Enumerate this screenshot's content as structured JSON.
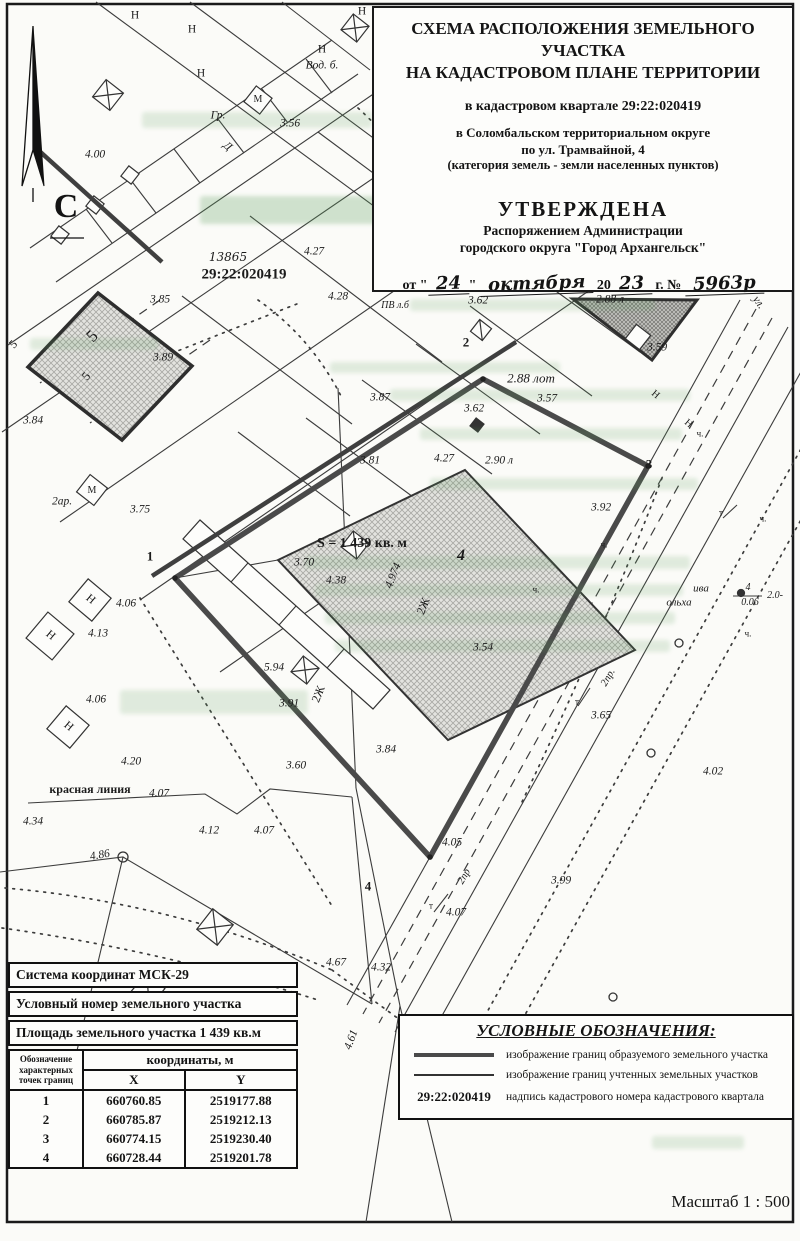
{
  "header": {
    "title_line1": "СХЕМА РАСПОЛОЖЕНИЯ ЗЕМЕЛЬНОГО УЧАСТКА",
    "title_line2": "НА КАДАСТРОВОМ ПЛАНЕ ТЕРРИТОРИИ",
    "subtitle_lines": [
      "в кадастровом квартале 29:22:020419",
      "в Соломбальском территориальном округе",
      "по ул. Трамвайной, 4",
      "(категория земель - земли населенных пунктов)"
    ],
    "approval": {
      "heading": "УТВЕРЖДЕНА",
      "org_line1": "Распоряжением Администрации",
      "org_line2": "городского округа \"Город Архангельск\"",
      "date_prefix": "от \"",
      "day": "24",
      "date_close": "\"",
      "month": "октября",
      "year_prefix": "20",
      "year": "23",
      "num_prefix": "г. №",
      "number": "5963р"
    },
    "scale_label": "Масштаб  1 : 500"
  },
  "compass": {
    "label": "С"
  },
  "map": {
    "area_label": "S = 1 439 кв. м",
    "quarter_number": "29:22:020419",
    "labels": [
      {
        "t": "4.00",
        "x": 95,
        "y": 155,
        "i": 1
      },
      {
        "t": "Н",
        "x": 135,
        "y": 16
      },
      {
        "t": "Н",
        "x": 192,
        "y": 30
      },
      {
        "t": "Н",
        "x": 201,
        "y": 74
      },
      {
        "t": "Н",
        "x": 322,
        "y": 50
      },
      {
        "t": "Н",
        "x": 362,
        "y": 12
      },
      {
        "t": "Вод. б.",
        "x": 322,
        "y": 66,
        "i": 1
      },
      {
        "t": "Гр.",
        "x": 218,
        "y": 116,
        "i": 1
      },
      {
        "t": "3.56",
        "x": 290,
        "y": 124,
        "i": 1
      },
      {
        "t": "Д",
        "x": 227,
        "y": 147,
        "r": 40,
        "i": 1
      },
      {
        "t": "М",
        "x": 258,
        "y": 100,
        "s": 10
      },
      {
        "t": "13865",
        "x": 228,
        "y": 257,
        "i": 1,
        "h": 1,
        "s": 12
      },
      {
        "t": "29:22:020419",
        "x": 244,
        "y": 275,
        "b": 1,
        "s": 15
      },
      {
        "t": "4.27",
        "x": 314,
        "y": 252,
        "i": 1
      },
      {
        "t": "4.28",
        "x": 338,
        "y": 297,
        "i": 1
      },
      {
        "t": "ПВ л.б",
        "x": 395,
        "y": 306,
        "s": 10,
        "i": 1
      },
      {
        "t": "3.62",
        "x": 478,
        "y": 301,
        "i": 1
      },
      {
        "t": "2.88 л",
        "x": 610,
        "y": 300,
        "i": 1
      },
      {
        "t": "ул.",
        "x": 758,
        "y": 303,
        "r": 55,
        "i": 1
      },
      {
        "t": "2",
        "x": 466,
        "y": 342,
        "b": 1,
        "s": 13
      },
      {
        "t": "3.59",
        "x": 657,
        "y": 348,
        "i": 1
      },
      {
        "t": "3.85",
        "x": 160,
        "y": 300,
        "i": 1
      },
      {
        "t": "3.89",
        "x": 163,
        "y": 358,
        "i": 1
      },
      {
        "t": "3.84",
        "x": 33,
        "y": 421,
        "i": 1
      },
      {
        "t": "5",
        "x": 92,
        "y": 336,
        "r": -45,
        "s": 17
      },
      {
        "t": "5",
        "x": 13,
        "y": 344,
        "r": -45,
        "s": 12
      },
      {
        "t": "5",
        "x": 86,
        "y": 376,
        "r": -50,
        "s": 12
      },
      {
        "t": "2ар.",
        "x": 62,
        "y": 502,
        "i": 1
      },
      {
        "t": "М",
        "x": 92,
        "y": 491,
        "s": 10
      },
      {
        "t": "3.75",
        "x": 140,
        "y": 510,
        "i": 1
      },
      {
        "t": "Н",
        "x": 90,
        "y": 600,
        "r": 40
      },
      {
        "t": "Н",
        "x": 50,
        "y": 636,
        "r": 40
      },
      {
        "t": "Н",
        "x": 68,
        "y": 727,
        "r": 40
      },
      {
        "t": "4.06",
        "x": 126,
        "y": 604,
        "i": 1
      },
      {
        "t": "4.13",
        "x": 98,
        "y": 634,
        "i": 1
      },
      {
        "t": "4.06",
        "x": 96,
        "y": 700,
        "i": 1
      },
      {
        "t": "1",
        "x": 150,
        "y": 556,
        "b": 1,
        "s": 13
      },
      {
        "t": "3.87",
        "x": 380,
        "y": 398,
        "i": 1
      },
      {
        "t": "3.62",
        "x": 474,
        "y": 409,
        "i": 1
      },
      {
        "t": "3.81",
        "x": 370,
        "y": 461,
        "i": 1
      },
      {
        "t": "4.27",
        "x": 444,
        "y": 459,
        "i": 1
      },
      {
        "t": "2.90 л",
        "x": 499,
        "y": 461,
        "i": 1
      },
      {
        "t": "3",
        "x": 649,
        "y": 464,
        "b": 1,
        "s": 13
      },
      {
        "t": "3.92",
        "x": 601,
        "y": 508,
        "i": 1
      },
      {
        "t": "2.88 лот",
        "x": 531,
        "y": 378,
        "i": 1,
        "s": 13
      },
      {
        "t": "3.57",
        "x": 547,
        "y": 399,
        "i": 1
      },
      {
        "t": "S = 1 439 кв. м",
        "x": 362,
        "y": 544,
        "b": 1,
        "s": 14
      },
      {
        "t": "3.70",
        "x": 304,
        "y": 563,
        "i": 1
      },
      {
        "t": "4.38",
        "x": 336,
        "y": 581,
        "i": 1
      },
      {
        "t": "4.974",
        "x": 394,
        "y": 576,
        "r": -68,
        "i": 1
      },
      {
        "t": "4",
        "x": 461,
        "y": 556,
        "s": 16,
        "i": 1,
        "b": 1
      },
      {
        "t": "2Ж",
        "x": 423,
        "y": 606,
        "r": -68,
        "s": 12
      },
      {
        "t": "2Ж",
        "x": 318,
        "y": 694,
        "r": -68,
        "s": 12
      },
      {
        "t": "3.54",
        "x": 483,
        "y": 648,
        "i": 1
      },
      {
        "t": "5.94",
        "x": 274,
        "y": 668,
        "i": 1
      },
      {
        "t": "3.91",
        "x": 289,
        "y": 704,
        "i": 1
      },
      {
        "t": "3.84",
        "x": 386,
        "y": 750,
        "i": 1
      },
      {
        "t": "3.60",
        "x": 296,
        "y": 766,
        "i": 1
      },
      {
        "t": "красная линия",
        "x": 90,
        "y": 789,
        "b": 1,
        "s": 12
      },
      {
        "t": "4.20",
        "x": 131,
        "y": 762,
        "i": 1
      },
      {
        "t": "4.07",
        "x": 159,
        "y": 794,
        "i": 1
      },
      {
        "t": "4.34",
        "x": 33,
        "y": 822,
        "i": 1
      },
      {
        "t": "4.12",
        "x": 209,
        "y": 831,
        "i": 1
      },
      {
        "t": "4.07",
        "x": 264,
        "y": 831,
        "i": 1
      },
      {
        "t": "4.86",
        "x": 100,
        "y": 856,
        "i": 1,
        "r": -10
      },
      {
        "t": "ива",
        "x": 701,
        "y": 589,
        "i": 1,
        "s": 11
      },
      {
        "t": "ольха",
        "x": 679,
        "y": 603,
        "i": 1,
        "s": 11
      },
      {
        "t": "4",
        "x": 748,
        "y": 588,
        "i": 1,
        "s": 10
      },
      {
        "t": "0.06",
        "x": 750,
        "y": 603,
        "i": 1,
        "s": 10
      },
      {
        "t": "2.0-",
        "x": 775,
        "y": 596,
        "i": 1,
        "s": 10
      },
      {
        "t": "2пр.",
        "x": 609,
        "y": 678,
        "r": -60,
        "i": 1,
        "s": 10.5
      },
      {
        "t": "3.65",
        "x": 601,
        "y": 716,
        "i": 1
      },
      {
        "t": "4.02",
        "x": 713,
        "y": 772,
        "i": 1
      },
      {
        "t": "т",
        "x": 577,
        "y": 702,
        "s": 9
      },
      {
        "t": "т",
        "x": 721,
        "y": 513,
        "s": 9
      },
      {
        "t": "т",
        "x": 431,
        "y": 906,
        "s": 9
      },
      {
        "t": "4.05",
        "x": 452,
        "y": 843,
        "i": 1
      },
      {
        "t": "2пр",
        "x": 465,
        "y": 877,
        "r": -60,
        "i": 1,
        "s": 10.5
      },
      {
        "t": "3.99",
        "x": 561,
        "y": 881,
        "i": 1
      },
      {
        "t": "4.07",
        "x": 456,
        "y": 913,
        "i": 1
      },
      {
        "t": "4",
        "x": 368,
        "y": 886,
        "b": 1,
        "s": 13
      },
      {
        "t": "4.32",
        "x": 381,
        "y": 968,
        "i": 1
      },
      {
        "t": "4.67",
        "x": 336,
        "y": 963,
        "i": 1
      },
      {
        "t": "4.61",
        "x": 352,
        "y": 1040,
        "r": -70,
        "i": 1
      },
      {
        "t": "ч.",
        "x": 700,
        "y": 434,
        "s": 9
      },
      {
        "t": "ч.",
        "x": 763,
        "y": 519,
        "s": 9
      },
      {
        "t": "ч.",
        "x": 748,
        "y": 634,
        "s": 9
      },
      {
        "t": "ч.",
        "x": 536,
        "y": 590,
        "s": 9
      },
      {
        "t": "ч.",
        "x": 604,
        "y": 545,
        "s": 9
      },
      {
        "t": "Н",
        "x": 655,
        "y": 395,
        "r": 40,
        "s": 10
      },
      {
        "t": "Н",
        "x": 688,
        "y": 424,
        "r": 40,
        "s": 10
      }
    ]
  },
  "table": {
    "row1": "Система координат МСК-29",
    "row2": "Условный номер земельного участка",
    "row3": "Площадь земельного участка 1 439 кв.м",
    "col_point": "Обозначение характерных точек границ",
    "col_coords": "координаты, м",
    "col_x": "X",
    "col_y": "Y",
    "points": [
      {
        "n": "1",
        "x": "660760.85",
        "y": "2519177.88"
      },
      {
        "n": "2",
        "x": "660785.87",
        "y": "2519212.13"
      },
      {
        "n": "3",
        "x": "660774.15",
        "y": "2519230.40"
      },
      {
        "n": "4",
        "x": "660728.44",
        "y": "2519201.78"
      }
    ]
  },
  "legend": {
    "title": "УСЛОВНЫЕ ОБОЗНАЧЕНИЯ:",
    "items": [
      {
        "symbol": "thick-line",
        "label": "изображение границ образуемого земельного участка"
      },
      {
        "symbol": "thin-line",
        "label": "изображение границ учтенных земельных участков"
      },
      {
        "symbol": "cadastral-number",
        "symbol_text": "29:22:020419",
        "label": "надпись кадастрового номера кадастрового квартала"
      }
    ]
  }
}
